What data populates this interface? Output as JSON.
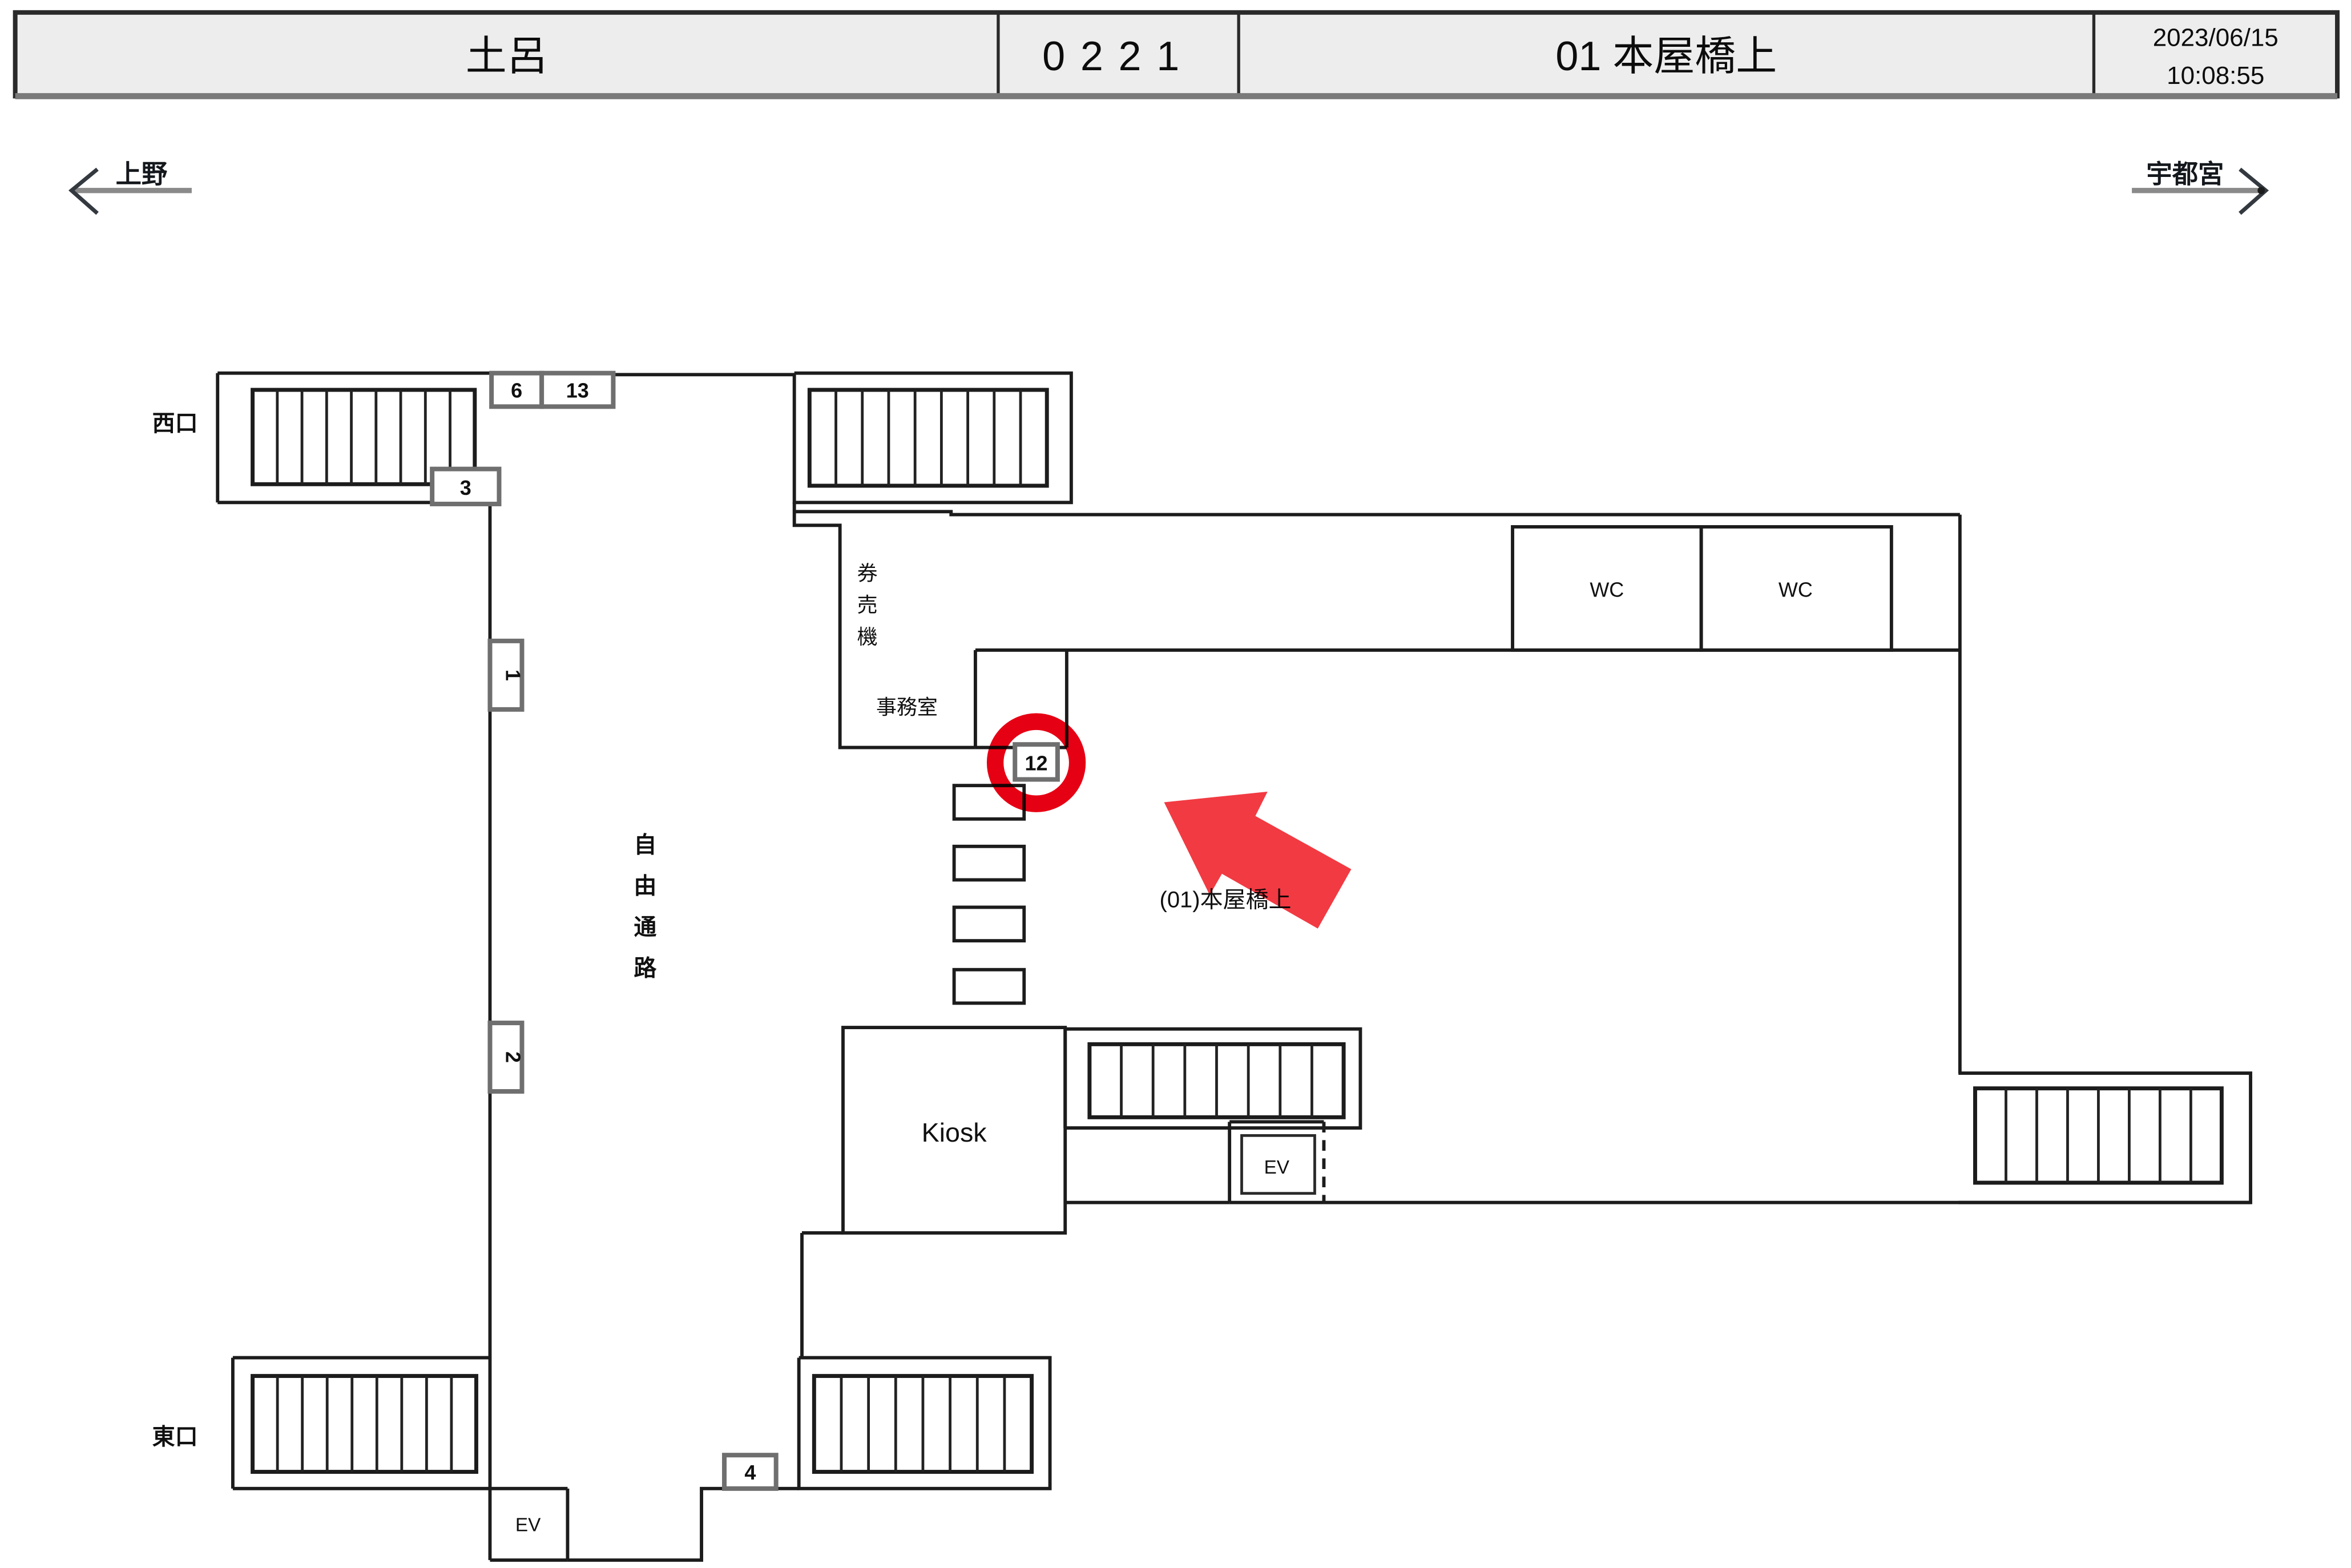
{
  "header": {
    "station": "土呂",
    "code": "0221",
    "location": "01 本屋橋上",
    "date": "2023/06/15",
    "time": "10:08:55"
  },
  "directions": {
    "left": "上野",
    "right": "宇都宮"
  },
  "labels": {
    "west_exit": "西口",
    "east_exit": "東口",
    "free_passage": {
      "c0": "自",
      "c1": "由",
      "c2": "通",
      "c3": "路"
    },
    "ticket_machines": {
      "c0": "券",
      "c1": "売",
      "c2": "機"
    },
    "office": "事務室",
    "wc_left": "WC",
    "wc_right": "WC",
    "kiosk": "Kiosk",
    "elevator_concourse": "EV",
    "elevator_passage": "EV",
    "annotation": "(01)本屋橋上"
  },
  "markers": {
    "m6": "6",
    "m13": "13",
    "m3": "3",
    "m1": "1",
    "m2": "2",
    "m12": "12",
    "m4": "4"
  },
  "colors": {
    "highlight_ring": "#e60014",
    "highlight_arrow": "#f23a42",
    "header_fill": "#ededed"
  }
}
